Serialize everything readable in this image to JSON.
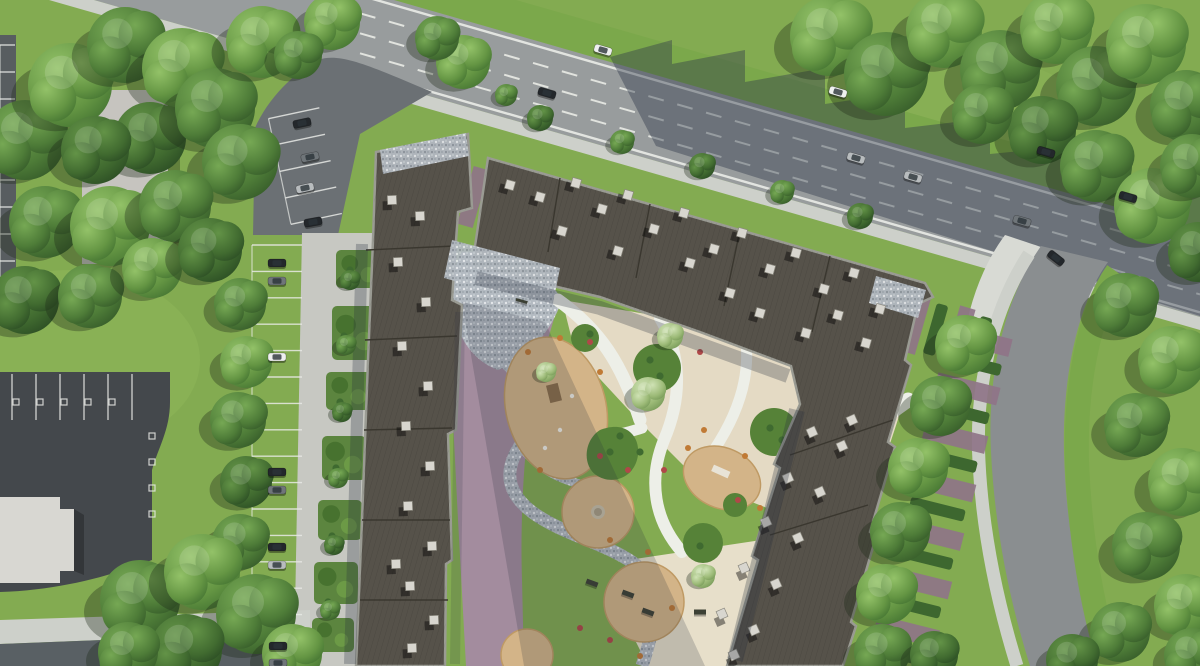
{
  "meta": {
    "kind": "aerial-architectural-render",
    "subject": "top-down render of residential complex with courtyard playground, parking and roads",
    "canvas_w": 1200,
    "canvas_h": 666
  },
  "palette": {
    "lawn": "#83ab51",
    "lawnLight": "#8fb75a",
    "lawnStrip": "#7ba84b",
    "treeShadow": "rgba(28,40,22,0.34)",
    "roadAsphalt": "#989c9d",
    "roadAsphaltRight": "#8a8e90",
    "roadShadow": "rgba(47,57,75,0.42)",
    "laneMark": "#e9ebe6",
    "sidewalk": "#cdd0ca",
    "sidewalkBright": "#d8dad4",
    "concreteWalk": "#c7c8c2",
    "asphaltAccess": "#6b7074",
    "asphaltDark": "#44484c",
    "asphaltMid": "#596064",
    "asphaltEdge": "#585d60",
    "stallLine": "#e8eae6",
    "paverPurple": "#8f7488",
    "paverMauve": "#a38c9e",
    "paverMauveLight": "#b5a0ae",
    "hedge": "#3d672f",
    "bedGreen": "#568238",
    "roof": "#56524a",
    "roofJoint": "#3a372f",
    "parapet": "#9a9b93",
    "ventTop": "#d8d6cf",
    "ventEdge": "#8b897f",
    "shadowSoft": "rgba(40,46,62,0.28)",
    "shadowCourt": "rgba(40,46,62,0.20)",
    "playTan": "#d3b488",
    "playTanEdge": "#bf9a64",
    "plazaBeige": "#e4dac4",
    "plazaBeige2": "#e7dfca",
    "pathWhite": "#edefe8",
    "equipWood": "#8b6f4a",
    "equipDark": "#3c4034",
    "flowerRed": "#b04848",
    "flowerOrange": "#c07a35",
    "bldLightRoof": "#c6c4bf",
    "bldWhiteRoof": "#d8d7d2",
    "carWhite": "#eef0ef",
    "carBlack": "#23272b",
    "carGray": "#6f7579",
    "carSilver": "#b8bcbe",
    "carGlass": "#2b3338"
  },
  "road": {
    "slope": 0.287,
    "dashes": [
      -50,
      -70,
      -90
    ],
    "solids": [
      -32,
      -108
    ],
    "xFrom": 360,
    "xTo": 1200
  },
  "trees": [
    [
      25,
      140,
      40,
      2
    ],
    [
      70,
      85,
      42,
      1
    ],
    [
      125,
      45,
      38,
      2
    ],
    [
      182,
      68,
      40,
      1
    ],
    [
      150,
      138,
      36,
      3
    ],
    [
      215,
      108,
      40,
      2
    ],
    [
      262,
      42,
      36,
      1
    ],
    [
      240,
      162,
      38,
      2
    ],
    [
      95,
      150,
      34,
      3
    ],
    [
      45,
      222,
      36,
      2
    ],
    [
      110,
      226,
      40,
      1
    ],
    [
      175,
      206,
      36,
      2
    ],
    [
      25,
      300,
      34,
      3
    ],
    [
      90,
      296,
      32,
      2
    ],
    [
      152,
      268,
      30,
      1
    ],
    [
      210,
      250,
      32,
      3
    ],
    [
      240,
      304,
      26,
      2
    ],
    [
      246,
      362,
      26,
      1
    ],
    [
      238,
      420,
      28,
      2
    ],
    [
      246,
      482,
      26,
      3
    ],
    [
      240,
      542,
      28,
      2
    ],
    [
      332,
      22,
      28,
      1
    ],
    [
      298,
      55,
      24,
      2
    ],
    [
      463,
      62,
      27,
      1
    ],
    [
      437,
      38,
      22,
      2
    ],
    [
      140,
      600,
      40,
      2
    ],
    [
      202,
      572,
      38,
      1
    ],
    [
      256,
      614,
      40,
      2
    ],
    [
      186,
      650,
      36,
      3
    ],
    [
      292,
      654,
      30,
      1
    ],
    [
      128,
      652,
      30,
      2
    ],
    [
      830,
      36,
      40,
      1
    ],
    [
      886,
      74,
      42,
      2
    ],
    [
      944,
      30,
      38,
      1
    ],
    [
      1000,
      70,
      40,
      2
    ],
    [
      1056,
      28,
      36,
      1
    ],
    [
      1096,
      86,
      40,
      2
    ],
    [
      1146,
      44,
      40,
      1
    ],
    [
      1186,
      106,
      36,
      2
    ],
    [
      1042,
      130,
      34,
      3
    ],
    [
      1096,
      166,
      36,
      2
    ],
    [
      1152,
      206,
      38,
      1
    ],
    [
      1192,
      166,
      32,
      2
    ],
    [
      1198,
      252,
      30,
      3
    ],
    [
      982,
      114,
      30,
      2
    ],
    [
      965,
      345,
      30,
      1
    ],
    [
      940,
      406,
      30,
      2
    ],
    [
      918,
      468,
      30,
      1
    ],
    [
      900,
      532,
      30,
      2
    ],
    [
      886,
      594,
      30,
      1
    ],
    [
      882,
      652,
      28,
      2
    ],
    [
      934,
      655,
      24,
      3
    ],
    [
      1125,
      305,
      32,
      2
    ],
    [
      1172,
      360,
      34,
      1
    ],
    [
      1136,
      425,
      32,
      2
    ],
    [
      1182,
      482,
      34,
      1
    ],
    [
      1146,
      546,
      34,
      2
    ],
    [
      1186,
      606,
      32,
      1
    ],
    [
      1120,
      632,
      30,
      2
    ],
    [
      1072,
      660,
      26,
      3
    ],
    [
      1192,
      656,
      28,
      2
    ],
    [
      540,
      118,
      13,
      3
    ],
    [
      622,
      142,
      12,
      2
    ],
    [
      702,
      166,
      13,
      3
    ],
    [
      782,
      192,
      12,
      2
    ],
    [
      860,
      216,
      13,
      3
    ],
    [
      506,
      95,
      11,
      2
    ],
    [
      350,
      280,
      10,
      3
    ],
    [
      346,
      345,
      10,
      2
    ],
    [
      342,
      412,
      10,
      3
    ],
    [
      338,
      478,
      10,
      2
    ],
    [
      334,
      545,
      10,
      3
    ],
    [
      330,
      610,
      10,
      2
    ],
    [
      648,
      394,
      17,
      4
    ],
    [
      670,
      336,
      13,
      4
    ],
    [
      703,
      576,
      12,
      4
    ],
    [
      546,
      372,
      10,
      4
    ]
  ],
  "cars": [
    [
      603,
      50,
      16,
      "white"
    ],
    [
      547,
      93,
      16,
      "black"
    ],
    [
      838,
      92,
      16,
      "white"
    ],
    [
      856,
      158,
      16,
      "silver"
    ],
    [
      913,
      177,
      16,
      "silver"
    ],
    [
      1046,
      152,
      16,
      "black"
    ],
    [
      1128,
      197,
      16,
      "black"
    ],
    [
      1022,
      221,
      16,
      "gray"
    ],
    [
      1056,
      258,
      38,
      "black"
    ],
    [
      302,
      123,
      -12,
      "black"
    ],
    [
      310,
      157,
      -12,
      "gray"
    ],
    [
      305,
      188,
      -12,
      "silver"
    ],
    [
      313,
      222,
      -10,
      "black"
    ],
    [
      277,
      263,
      0,
      "black"
    ],
    [
      277,
      281,
      0,
      "gray"
    ],
    [
      277,
      357,
      0,
      "white"
    ],
    [
      277,
      472,
      0,
      "black"
    ],
    [
      277,
      490,
      0,
      "gray"
    ],
    [
      277,
      547,
      0,
      "black"
    ],
    [
      277,
      565,
      0,
      "silver"
    ],
    [
      278,
      646,
      0,
      "black"
    ],
    [
      278,
      663,
      0,
      "gray"
    ]
  ],
  "vents": {
    "rotA": 16,
    "rotB": -2,
    "rotC": -24,
    "a": [
      [
        510,
        185
      ],
      [
        540,
        197
      ],
      [
        576,
        183
      ],
      [
        602,
        209
      ],
      [
        628,
        195
      ],
      [
        654,
        229
      ],
      [
        684,
        213
      ],
      [
        714,
        249
      ],
      [
        742,
        233
      ],
      [
        770,
        269
      ],
      [
        796,
        253
      ],
      [
        824,
        289
      ],
      [
        854,
        273
      ],
      [
        880,
        309
      ],
      [
        838,
        315
      ],
      [
        618,
        251
      ],
      [
        562,
        231
      ],
      [
        690,
        263
      ],
      [
        730,
        293
      ],
      [
        760,
        313
      ],
      [
        866,
        343
      ],
      [
        806,
        333
      ]
    ],
    "b": [
      [
        392,
        200
      ],
      [
        420,
        216
      ],
      [
        398,
        262
      ],
      [
        426,
        302
      ],
      [
        402,
        346
      ],
      [
        428,
        386
      ],
      [
        406,
        426
      ],
      [
        430,
        466
      ],
      [
        408,
        506
      ],
      [
        432,
        546
      ],
      [
        410,
        586
      ],
      [
        434,
        620
      ],
      [
        412,
        648
      ],
      [
        396,
        564
      ]
    ],
    "c": [
      [
        812,
        432
      ],
      [
        842,
        446
      ],
      [
        788,
        478
      ],
      [
        820,
        492
      ],
      [
        766,
        522
      ],
      [
        798,
        538
      ],
      [
        744,
        568
      ],
      [
        776,
        584
      ],
      [
        722,
        614
      ],
      [
        754,
        630
      ],
      [
        734,
        655
      ],
      [
        852,
        420
      ]
    ]
  },
  "stalls": {
    "mainCol": {
      "x": 252,
      "w": 50,
      "y0": 245,
      "dy": 26.4,
      "n": 16
    },
    "topCol": {
      "x": 280,
      "w": 52,
      "y0": 112,
      "dy": 27,
      "n": 5,
      "rot": -12,
      "cx": 306,
      "cy": 170
    },
    "leftEdge": {
      "x": 0,
      "w": 15,
      "y0": 45,
      "dy": 27,
      "n": 10
    },
    "lotRow": {
      "x0": 12,
      "dx": 24,
      "n": 6,
      "y": 374,
      "h": 46
    },
    "lotMarks": [
      [
        16,
        402
      ],
      [
        40,
        402
      ],
      [
        64,
        402
      ],
      [
        88,
        402
      ],
      [
        112,
        402
      ],
      [
        152,
        436
      ],
      [
        152,
        462
      ],
      [
        152,
        488
      ],
      [
        152,
        514
      ]
    ]
  },
  "stripes": {
    "north": {
      "ox": 412,
      "oy": 142,
      "rot": 16,
      "x0": 20,
      "pitch": 46,
      "n": 13,
      "purple": [
        0,
        6,
        16,
        60
      ],
      "hedge": [
        23,
        10,
        12,
        52
      ]
    },
    "east": {
      "ox": 935,
      "oy": 320,
      "rot": 104,
      "x0": 0,
      "pitch": 50,
      "n": 7,
      "purple": [
        0,
        -80,
        18,
        64
      ],
      "hedge": [
        27,
        -76,
        12,
        56
      ]
    }
  },
  "islands": [
    [
      336,
      250,
      46,
      38
    ],
    [
      332,
      306,
      46,
      54
    ],
    [
      326,
      372,
      46,
      38
    ],
    [
      322,
      436,
      44,
      44
    ],
    [
      318,
      500,
      44,
      40
    ],
    [
      314,
      562,
      44,
      42
    ],
    [
      312,
      618,
      42,
      34
    ]
  ],
  "benches": [
    [
      592,
      583,
      20
    ],
    [
      628,
      594,
      20
    ],
    [
      648,
      612,
      20
    ],
    [
      700,
      612,
      0
    ],
    [
      775,
      526,
      -28
    ],
    [
      846,
      470,
      -28
    ],
    [
      522,
      300,
      16
    ],
    [
      868,
      424,
      -28
    ]
  ],
  "accents": {
    "red": [
      [
        600,
        456
      ],
      [
        628,
        470
      ],
      [
        590,
        342
      ],
      [
        738,
        500
      ],
      [
        610,
        640
      ],
      [
        580,
        628
      ],
      [
        664,
        470
      ],
      [
        700,
        352
      ]
    ],
    "orange": [
      [
        528,
        352
      ],
      [
        600,
        372
      ],
      [
        648,
        552
      ],
      [
        688,
        448
      ],
      [
        745,
        456
      ],
      [
        640,
        656
      ],
      [
        540,
        470
      ],
      [
        610,
        540
      ],
      [
        672,
        608
      ],
      [
        704,
        430
      ],
      [
        760,
        508
      ],
      [
        560,
        338
      ]
    ],
    "shrub": [
      [
        830,
        420
      ],
      [
        816,
        456
      ],
      [
        800,
        492
      ],
      [
        786,
        528
      ],
      [
        772,
        564
      ],
      [
        760,
        600
      ],
      [
        748,
        636
      ],
      [
        620,
        436
      ],
      [
        640,
        452
      ],
      [
        610,
        452
      ],
      [
        660,
        376
      ],
      [
        650,
        360
      ],
      [
        700,
        546
      ],
      [
        770,
        428
      ],
      [
        782,
        440
      ],
      [
        590,
        334
      ],
      [
        350,
        270
      ],
      [
        344,
        336
      ],
      [
        340,
        402
      ],
      [
        336,
        468
      ],
      [
        332,
        536
      ],
      [
        328,
        602
      ]
    ]
  }
}
